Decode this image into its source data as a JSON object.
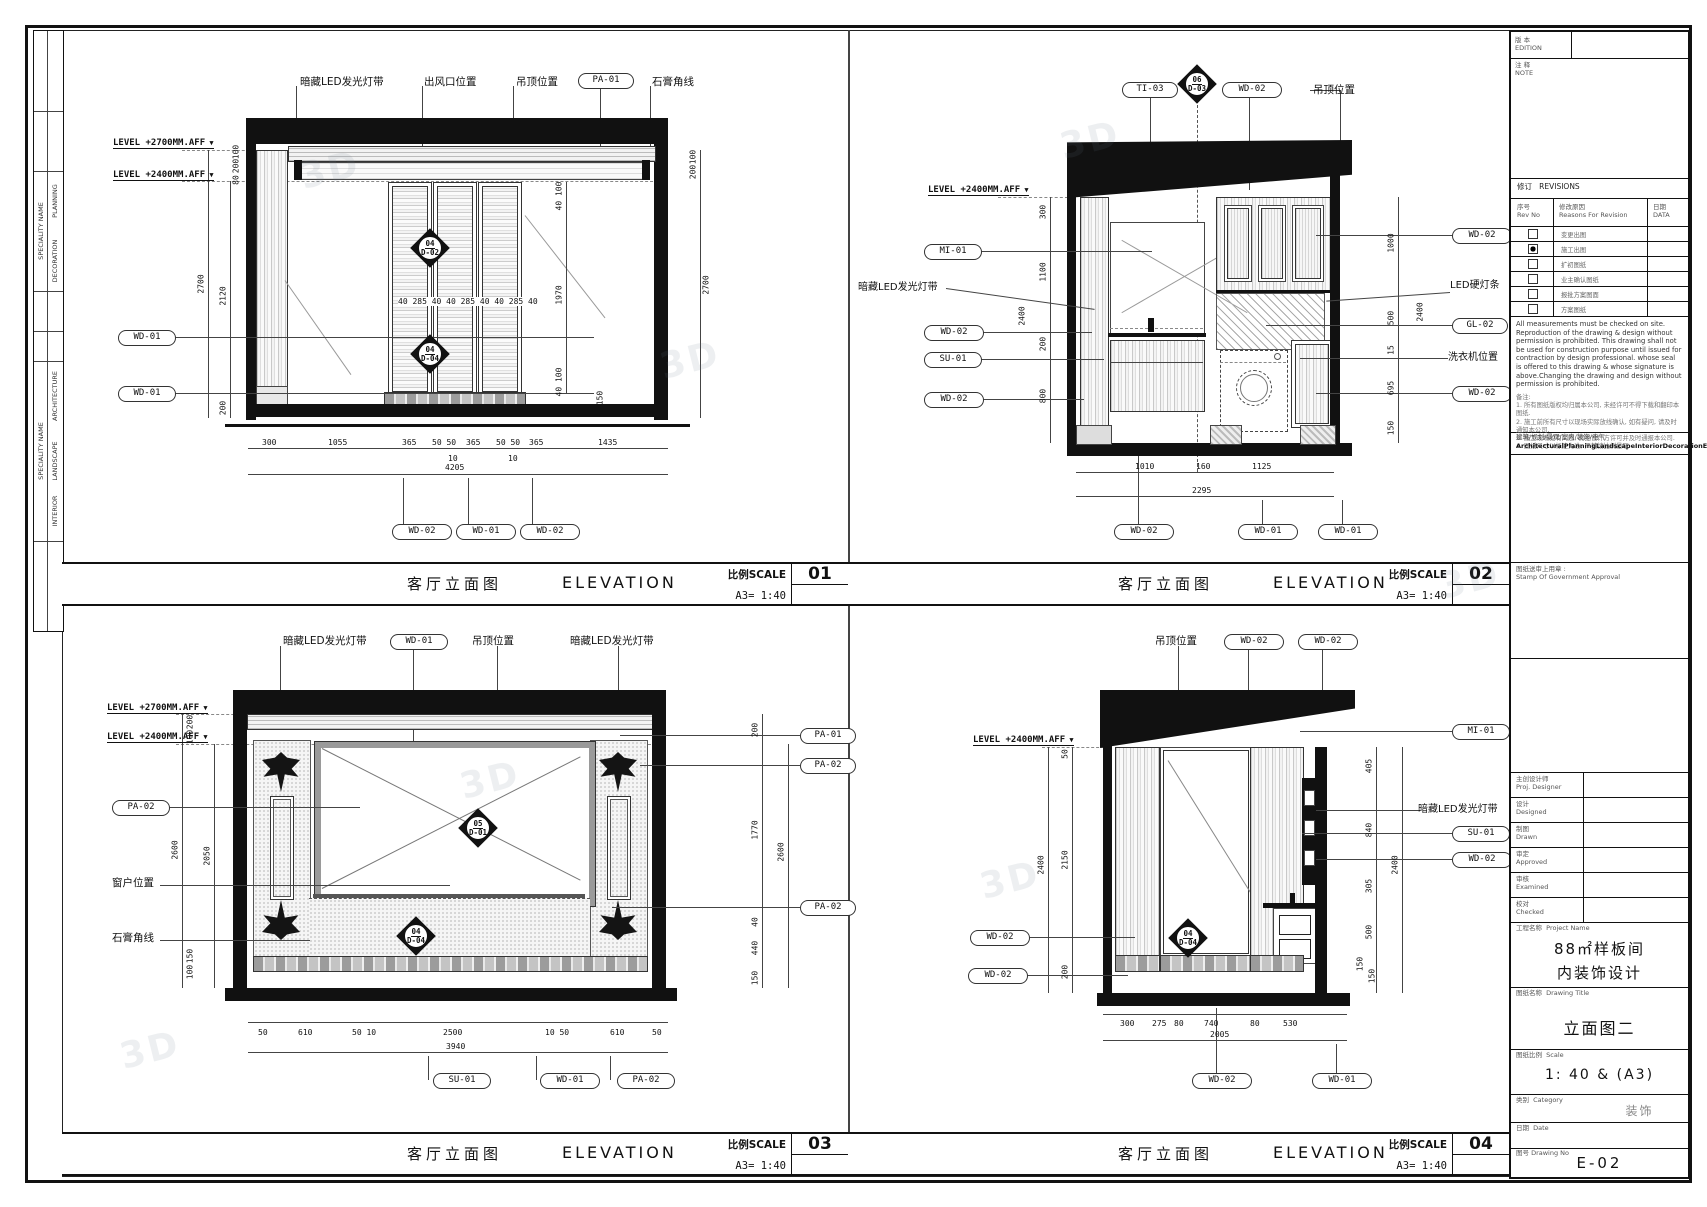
{
  "watermark": "3D",
  "left_strip": {
    "g1_header": "SPECIALITY NAME",
    "g1_rows": [
      "PLANNING",
      "DECORATION"
    ],
    "g2_header": "SPECIALITY NAME",
    "g2_rows": [
      "ARCHITECTURE",
      "LANDSCAPE",
      "INTERIOR"
    ]
  },
  "views": {
    "v01": {
      "no": "01",
      "title_cn": "客厅立面图",
      "title_en": "ELEVATION",
      "scale_cap": "比例SCALE",
      "scale_val": "A3= 1:40",
      "top": [
        "暗藏LED发光灯带",
        "出风口位置",
        "吊顶位置",
        "PA-01",
        "石膏角线"
      ],
      "lv1": "LEVEL +2700MM.AFF",
      "lv2": "LEVEL +2400MM.AFF",
      "lc": [
        "WD-01",
        "WD-01"
      ],
      "bc": [
        "WD-02",
        "WD-01",
        "WD-02"
      ],
      "d1t": "04",
      "d1b": "D-02",
      "d2t": "04",
      "d2b": "D-04",
      "ld": [
        "100",
        "200",
        "80",
        "2700",
        "2120",
        "200"
      ],
      "rd": [
        "40 100",
        "1970",
        "40 100",
        "150",
        "100",
        "200",
        "2700"
      ],
      "door_dims": "40 285 40  40 285 40  40 285 40",
      "b": [
        "300",
        "1055",
        "365",
        "50 50",
        "365",
        "50 50",
        "365",
        "1435"
      ],
      "bs1": "10",
      "bs2": "10",
      "bt": "4205"
    },
    "v02": {
      "no": "02",
      "title_cn": "客厅立面图",
      "title_en": "ELEVATION",
      "scale_cap": "比例SCALE",
      "scale_val": "A3= 1:40",
      "top": [
        "TI-03",
        "WD-02",
        "吊顶位置"
      ],
      "dt": "06",
      "db": "D-03",
      "lv": "LEVEL +2400MM.AFF",
      "lc": [
        "MI-01",
        "暗藏LED发光灯带",
        "WD-02",
        "SU-01",
        "WD-02"
      ],
      "rc": [
        "WD-02",
        "LED硬灯条",
        "GL-02",
        "洗衣机位置",
        "WD-02"
      ],
      "bc": [
        "WD-02",
        "WD-01",
        "WD-01"
      ],
      "ld": [
        "300",
        "1100",
        "2400",
        "200",
        "800"
      ],
      "rd": [
        "1000",
        "500",
        "2400",
        "15",
        "695",
        "150"
      ],
      "b": [
        "1010",
        "160",
        "1125"
      ],
      "bt": "2295"
    },
    "v03": {
      "no": "03",
      "title_cn": "客厅立面图",
      "title_en": "ELEVATION",
      "scale_cap": "比例SCALE",
      "scale_val": "A3= 1:40",
      "top": [
        "暗藏LED发光灯带",
        "WD-01",
        "吊顶位置",
        "暗藏LED发光灯带"
      ],
      "lv1": "LEVEL +2700MM.AFF",
      "lv2": "LEVEL +2400MM.AFF",
      "lc": [
        "PA-02",
        "窗户位置",
        "石膏角线"
      ],
      "rc": [
        "PA-01",
        "PA-02",
        "PA-02"
      ],
      "bc": [
        "SU-01",
        "WD-01",
        "PA-02"
      ],
      "d1t": "05",
      "d1b": "D-01",
      "d2t": "04",
      "d2b": "D-04",
      "ld": [
        "200",
        "100",
        "2600",
        "2050",
        "150",
        "100"
      ],
      "rd": [
        "200",
        "1770",
        "2600",
        "40",
        "440",
        "150"
      ],
      "b": [
        "50",
        "610",
        "50 10",
        "2500",
        "10 50",
        "610",
        "50"
      ],
      "bt": "3940"
    },
    "v04": {
      "no": "04",
      "title_cn": "客厅立面图",
      "title_en": "ELEVATION",
      "scale_cap": "比例SCALE",
      "scale_val": "A3= 1:40",
      "top": [
        "吊顶位置",
        "WD-02",
        "WD-02"
      ],
      "lv": "LEVEL +2400MM.AFF",
      "lc": [
        "WD-02",
        "WD-02"
      ],
      "rc": [
        "MI-01",
        "暗藏LED发光灯带",
        "SU-01",
        "WD-02"
      ],
      "bc": [
        "WD-02",
        "WD-01"
      ],
      "dt": "04",
      "db": "D-04",
      "ld": [
        "50",
        "2400",
        "2150",
        "200"
      ],
      "rd": [
        "405",
        "840",
        "2400",
        "305",
        "500",
        "150",
        "150"
      ],
      "b": [
        "300",
        "275",
        "80",
        "740",
        "80",
        "530"
      ],
      "bt": "2005"
    }
  },
  "titleblock": {
    "edition_cn": "版 本",
    "edition_en": "EDITION",
    "note_cn": "注 释",
    "note_en": "NOTE",
    "revisions": "修订   REVISIONS",
    "rev_no": "序号\nRev No",
    "rev_reason": "修改原因\nReasons For Revision",
    "rev_date": "日期\nDATA",
    "rev_rows": [
      {
        "label": "变更出图",
        "checked": false
      },
      {
        "label": "施工出图",
        "checked": true
      },
      {
        "label": "扩初图纸",
        "checked": false
      },
      {
        "label": "业主确认图纸",
        "checked": false
      },
      {
        "label": "报批方案图面",
        "checked": false
      },
      {
        "label": "方案图纸",
        "checked": false
      }
    ],
    "disclaimer": "All measurements must be checked on site. Reproduction of the drawing & design without permission is prohibited. This drawing shall not be used for construction purpose until issued for contraction by design professional. whose seal is offered to this drawing & whose signature is above.Changing the drawing and design without permission is prohibited.",
    "notes": [
      "备注:",
      "1. 所有图纸版权均归属本公司, 未经许可不得下载和翻印本图纸.",
      "2. 施工前所有尺寸以现场实际放线确认, 如有疑问, 请及时通知本公司.",
      "3. 施工现场如有问题, 需经设计方许可并及时通报本公司.",
      "4. 图纸尺寸以标注为准, 严禁按比例量取."
    ],
    "scope_cn": "建筑/规划/景观/室内/装饰/电气",
    "scope_en": "ArchitecturalPlanningLandscapeInteriorDecorationElectrical",
    "stamp_cn": "图纸送审上用章 :",
    "stamp_en": "Stamp Of Government Approval",
    "staff": [
      {
        "cn": "主创设计师",
        "en": "Proj. Designer"
      },
      {
        "cn": "设计",
        "en": "Designed"
      },
      {
        "cn": "制图",
        "en": "Drawn"
      },
      {
        "cn": "审定",
        "en": "Approved"
      },
      {
        "cn": "审核",
        "en": "Examined"
      },
      {
        "cn": "校对",
        "en": "Checked"
      }
    ],
    "project_cap": "工程名称  Project Name",
    "project_1": "88㎡样板间",
    "project_2": "内装饰设计",
    "dwgtitle_cap": "图纸名称  Drawing Title",
    "dwgtitle": "立面图二",
    "scale_cap": "图纸比例  Scale",
    "scale": "1: 40  &  (A3)",
    "category_cap": "类别  Category",
    "category": "装饰",
    "date_cap": "日期  Date",
    "dwgno_cap": "图号 Drawing No",
    "dwgno": "E-02"
  }
}
